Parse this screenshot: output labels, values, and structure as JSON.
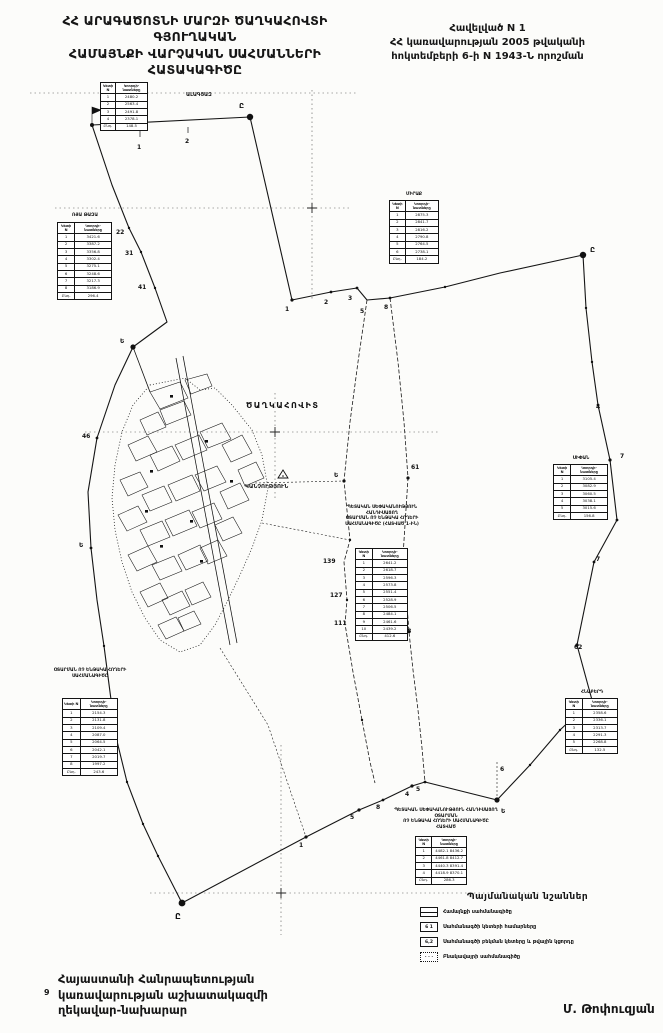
{
  "header": {
    "title_lines": [
      "ՀՀ ԱՐԱԳԱԾՈՏՆԻ ՄԱՐԶԻ ԾԱՂԿԱՀՈՎՏԻ ԳՅՈՒՂԱԿԱՆ",
      "ՀԱՄԱՅՆՔԻ ՎԱՐՉԱԿԱՆ  ՍԱՀՄԱՆՆԵՐԻ",
      "ՀԱՏԱԿԱԳԻԾԸ"
    ],
    "appendix_lines": [
      "Հավելված N 1",
      "ՀՀ կառավարության 2005 թվականի",
      "հոկտեմբերի 6-ի N 1943-Ն որոշման"
    ]
  },
  "map": {
    "labels": [
      {
        "text": "ԱԼԱԳՅԱԶ",
        "x": 186,
        "y": 92,
        "size": 5,
        "bold": 1
      },
      {
        "text": "ԾԱՂԿԱՀՈՎԻՏ",
        "x": 246,
        "y": 401,
        "size": 8,
        "bold": 1,
        "spacing": 1.5
      },
      {
        "text": "ԿԱՆՉՈՒԹՅՈՒՆ",
        "x": 245,
        "y": 484,
        "size": 5.5,
        "bold": 1
      }
    ],
    "point_labels": [
      {
        "t": "Ը",
        "x": 239,
        "y": 108,
        "s": 7
      },
      {
        "t": "1",
        "x": 137,
        "y": 149,
        "s": 6
      },
      {
        "t": "2",
        "x": 185,
        "y": 143,
        "s": 6
      },
      {
        "t": "22",
        "x": 116,
        "y": 234,
        "s": 6
      },
      {
        "t": "31",
        "x": 125,
        "y": 255,
        "s": 6
      },
      {
        "t": "41",
        "x": 138,
        "y": 289,
        "s": 6
      },
      {
        "t": "1",
        "x": 285,
        "y": 311,
        "s": 6
      },
      {
        "t": "2",
        "x": 324,
        "y": 304,
        "s": 6
      },
      {
        "t": "3",
        "x": 348,
        "y": 300,
        "s": 6
      },
      {
        "t": "5",
        "x": 360,
        "y": 313,
        "s": 6
      },
      {
        "t": "8",
        "x": 384,
        "y": 309,
        "s": 6
      },
      {
        "t": "Ը",
        "x": 590,
        "y": 252,
        "s": 7
      },
      {
        "t": "4",
        "x": 596,
        "y": 409,
        "s": 6
      },
      {
        "t": "7",
        "x": 620,
        "y": 458,
        "s": 6
      },
      {
        "t": "7",
        "x": 596,
        "y": 561,
        "s": 6
      },
      {
        "t": "62",
        "x": 574,
        "y": 649,
        "s": 6
      },
      {
        "t": "Ե",
        "x": 334,
        "y": 477,
        "s": 6
      },
      {
        "t": "61",
        "x": 411,
        "y": 469,
        "s": 6
      },
      {
        "t": "139",
        "x": 323,
        "y": 563,
        "s": 6
      },
      {
        "t": "127",
        "x": 330,
        "y": 597,
        "s": 6
      },
      {
        "t": "111",
        "x": 334,
        "y": 625,
        "s": 6
      },
      {
        "t": "58",
        "x": 395,
        "y": 561,
        "s": 6
      },
      {
        "t": "7",
        "x": 400,
        "y": 591,
        "s": 6
      },
      {
        "t": "78",
        "x": 403,
        "y": 633,
        "s": 6
      },
      {
        "t": "6",
        "x": 500,
        "y": 771,
        "s": 6
      },
      {
        "t": "Ե",
        "x": 501,
        "y": 813,
        "s": 6
      },
      {
        "t": "4",
        "x": 405,
        "y": 796,
        "s": 6
      },
      {
        "t": "5",
        "x": 416,
        "y": 791,
        "s": 6
      },
      {
        "t": "8",
        "x": 376,
        "y": 809,
        "s": 6
      },
      {
        "t": "5",
        "x": 350,
        "y": 819,
        "s": 6
      },
      {
        "t": "1",
        "x": 299,
        "y": 847,
        "s": 6
      },
      {
        "t": "Ը",
        "x": 175,
        "y": 919,
        "s": 8
      },
      {
        "t": "Ե",
        "x": 120,
        "y": 343,
        "s": 6
      },
      {
        "t": "46",
        "x": 82,
        "y": 438,
        "s": 6
      },
      {
        "t": "Ե",
        "x": 79,
        "y": 547,
        "s": 6
      }
    ]
  },
  "tables": [
    {
      "x": 100,
      "y": 82,
      "w": 48,
      "label": null,
      "header": [
        "Կետի N",
        "Կոորդի- նատները"
      ],
      "rows": [
        [
          "1",
          "2480.2"
        ],
        [
          "2",
          "2563.4"
        ],
        [
          "3",
          "2491.8"
        ],
        [
          "4",
          "2378.1"
        ],
        [
          "Ընդ.",
          "148.5"
        ]
      ]
    },
    {
      "x": 57,
      "y": 222,
      "w": 55,
      "label": {
        "x": 50,
        "y": 213,
        "w": 70,
        "lines": [
          "ՌՅԱ ԹԱԶԱ"
        ]
      },
      "header": [
        "Կետի N",
        "Կոորդի- նատները"
      ],
      "rows": [
        [
          "1",
          "3421.6"
        ],
        [
          "2",
          "3387.2"
        ],
        [
          "3",
          "3356.8"
        ],
        [
          "4",
          "3302.4"
        ],
        [
          "5",
          "3275.1"
        ],
        [
          "6",
          "3248.6"
        ],
        [
          "7",
          "3217.3"
        ],
        [
          "8",
          "3186.9"
        ],
        [
          "Ընդ.",
          "296.4"
        ]
      ]
    },
    {
      "x": 389,
      "y": 200,
      "w": 50,
      "label": {
        "x": 382,
        "y": 192,
        "w": 64,
        "lines": [
          "ՄԻՐԱՔ"
        ]
      },
      "header": [
        "Կետի N",
        "Կոորդի- նատները"
      ],
      "rows": [
        [
          "1",
          "2875.3"
        ],
        [
          "2",
          "2841.7"
        ],
        [
          "3",
          "2816.2"
        ],
        [
          "4",
          "2790.8"
        ],
        [
          "5",
          "2764.5"
        ],
        [
          "6",
          "2738.1"
        ],
        [
          "Ընդ.",
          "184.2"
        ]
      ]
    },
    {
      "x": 355,
      "y": 548,
      "w": 53,
      "label": {
        "x": 332,
        "y": 505,
        "w": 100,
        "lines": [
          "ՊԵՏԱԿԱՆ ՍԵՓԱԿԱՆՈՒԹՅՈՒՆ ՀԱՆԴԻՍԱՑՈՂ",
          "ՕՏԱՐՄԱՆ ՈՉ ԵՆԹԱԿԱ ՀՈՂԵՐԻ",
          "ՍԱՀՄԱՆԱԳԻԾԸ (ՀԱՏՎԱԾ 1-ԻՆ)"
        ]
      },
      "header": [
        "Կետի N",
        "Կոորդի- նատները"
      ],
      "rows": [
        [
          "1",
          "2641.2"
        ],
        [
          "2",
          "2618.7"
        ],
        [
          "3",
          "2596.3"
        ],
        [
          "4",
          "2573.8"
        ],
        [
          "5",
          "2551.4"
        ],
        [
          "6",
          "2528.9"
        ],
        [
          "7",
          "2506.5"
        ],
        [
          "8",
          "2484.1"
        ],
        [
          "9",
          "2461.6"
        ],
        [
          "10",
          "2439.2"
        ],
        [
          "Ընդ.",
          "412.6"
        ]
      ]
    },
    {
      "x": 553,
      "y": 464,
      "w": 55,
      "label": {
        "x": 546,
        "y": 456,
        "w": 70,
        "lines": [
          "ՍԻՓԱՆ"
        ]
      },
      "header": [
        "Կետի N",
        "Կոորդի- նատները"
      ],
      "rows": [
        [
          "1",
          "3105.4"
        ],
        [
          "2",
          "3082.9"
        ],
        [
          "3",
          "3060.5"
        ],
        [
          "4",
          "3038.1"
        ],
        [
          "5",
          "3015.6"
        ],
        [
          "Ընդ.",
          "156.8"
        ]
      ]
    },
    {
      "x": 565,
      "y": 698,
      "w": 53,
      "label": {
        "x": 558,
        "y": 690,
        "w": 68,
        "lines": [
          "ՀՆԱԲԵՐԴ"
        ]
      },
      "header": [
        "Կետի N",
        "Կոորդի- նատները"
      ],
      "rows": [
        [
          "1",
          "2358.6"
        ],
        [
          "2",
          "2336.1"
        ],
        [
          "3",
          "2313.7"
        ],
        [
          "4",
          "2291.3"
        ],
        [
          "5",
          "2268.8"
        ],
        [
          "Ընդ.",
          "132.5"
        ]
      ]
    },
    {
      "x": 415,
      "y": 836,
      "w": 52,
      "label": {
        "x": 388,
        "y": 808,
        "w": 116,
        "lines": [
          "ՊԵՏԱԿԱՆ ՍԵՓԱԿԱՆՈՒԹՅՈՒՆ ՀԱՆԴԻՍԱՑՈՂ ՕՏԱՐՄԱՆ",
          "ՈՉ ԵՆԹԱԿԱ ՀՈՂԵՐԻ ՍԱՀՄԱՆԱԳԻԾԸ",
          "ՀԱՏՎԱԾ"
        ]
      },
      "header": [
        "Կետի N",
        "Կոորդի- նատները"
      ],
      "rows": [
        [
          "1",
          "4482.1  8436.2"
        ],
        [
          "2",
          "4461.8  8412.7"
        ],
        [
          "3",
          "4440.3  8391.4"
        ],
        [
          "4",
          "4418.9  8370.1"
        ],
        [
          "Ընդ.",
          "286.3"
        ]
      ]
    },
    {
      "x": 62,
      "y": 698,
      "w": 56,
      "label": {
        "x": 40,
        "y": 668,
        "w": 100,
        "lines": [
          "ՕՏԱՐՄԱՆ ՈՉ ԵՆԹԱԿԱ ՀՈՂԵՐԻ",
          "ՍԱՀՄԱՆԱԳԻԾԸ"
        ]
      },
      "header": [
        "Կետի N",
        "Կոորդի- նատները"
      ],
      "rows": [
        [
          "1",
          "2154.3"
        ],
        [
          "2",
          "2131.8"
        ],
        [
          "3",
          "2109.4"
        ],
        [
          "4",
          "2087.0"
        ],
        [
          "5",
          "2064.5"
        ],
        [
          "6",
          "2042.1"
        ],
        [
          "7",
          "2019.7"
        ],
        [
          "8",
          "1997.2"
        ],
        [
          "Ընդ.",
          "243.6"
        ]
      ]
    }
  ],
  "legend": {
    "title": "Պայմանական նշաններ",
    "items": [
      {
        "icon": "boundary",
        "icon_text": "",
        "label": "Համայնքի սահմանագիծը"
      },
      {
        "icon": "numbers",
        "icon_text": "6 1",
        "label": "Սահմանագծի կետերի համարները"
      },
      {
        "icon": "distance",
        "icon_text": "6,2",
        "label": "Սահմանագծի բեկման կետերը և թվային կցորդը"
      },
      {
        "icon": "settlement",
        "icon_text": "· · ·",
        "label": "Բնակավայրի սահմանագիծը"
      }
    ]
  },
  "footer": {
    "left_lines": [
      "Հայաստանի Հանրապետության",
      "կառավարության աշխատակազմի",
      "ղեկավար-նախարար"
    ],
    "left_mark": "9",
    "signature": "Մ. Թոփուզյան"
  }
}
